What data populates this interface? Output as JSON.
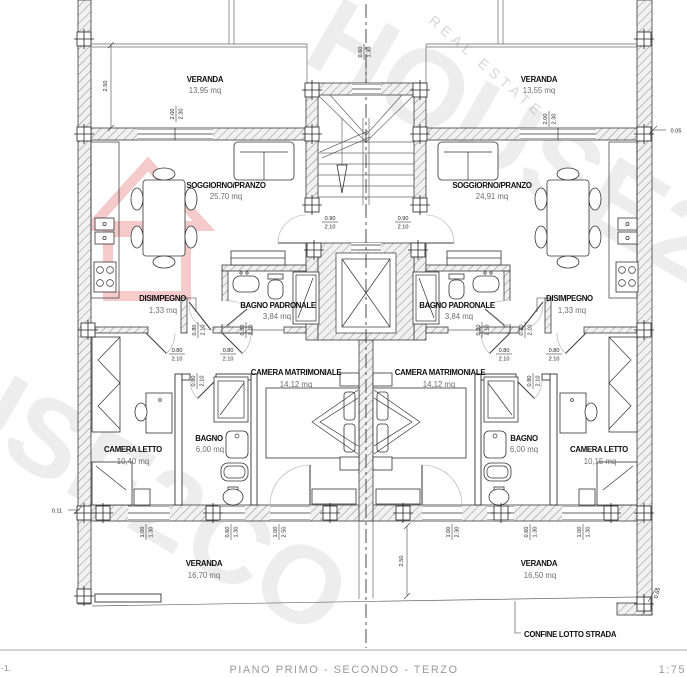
{
  "sheet": {
    "title": "PIANO PRIMO - SECONDO - TERZO",
    "scale": "1:75",
    "corner_note": "-1.",
    "boundary_label": "CONFINE LOTTO STRADA"
  },
  "watermark": {
    "big_text": "HOUSE2CO",
    "sub_text": "REAL ESTATE",
    "house_color": "#e06060"
  },
  "apartments": {
    "left": {
      "veranda_top": {
        "name": "VERANDA",
        "area": "13,95 mq"
      },
      "soggiorno": {
        "name": "SOGGIORNO/PRANZO",
        "area": "25.70 mq"
      },
      "disimpegno": {
        "name": "DISIMPEGNO",
        "area": "1,33 mq"
      },
      "bagno_padronale": {
        "name": "BAGNO PADRONALE",
        "area": "3,84 mq"
      },
      "camera_matrimoniale": {
        "name": "CAMERA MATRIMONIALE",
        "area": "14,12 mq"
      },
      "bagno": {
        "name": "BAGNO",
        "area": "6,00 mq"
      },
      "camera_letto": {
        "name": "CAMERA LETTO",
        "area": "10,40 mq"
      },
      "veranda_bottom": {
        "name": "VERANDA",
        "area": "16,70 mq"
      }
    },
    "right": {
      "veranda_top": {
        "name": "VERANDA",
        "area": "13,55 mq"
      },
      "soggiorno": {
        "name": "SOGGIORNO/PRANZO",
        "area": "24,91 mq"
      },
      "disimpegno": {
        "name": "DISIMPEGNO",
        "area": "1,33 mq"
      },
      "bagno_padronale": {
        "name": "BAGNO PADRONALE",
        "area": "3,84 mq"
      },
      "camera_matrimoniale": {
        "name": "CAMERA MATRIMONIALE",
        "area": "14,12 mq"
      },
      "bagno": {
        "name": "BAGNO",
        "area": "6,00 mq"
      },
      "camera_letto": {
        "name": "CAMERA LETTO",
        "area": "10,15 mq"
      },
      "veranda_bottom": {
        "name": "VERANDA",
        "area": "16,50 mq"
      }
    }
  },
  "dims": {
    "d005": "0.05",
    "d011": "0.11",
    "d060": "0.60",
    "d065": "0.65",
    "d080": "0.80",
    "d090": "0.90",
    "d100": "1.00",
    "d130": "1.30",
    "d200": "2.00",
    "d210": "2.10",
    "d230": "2.30",
    "d250": "2.50"
  }
}
